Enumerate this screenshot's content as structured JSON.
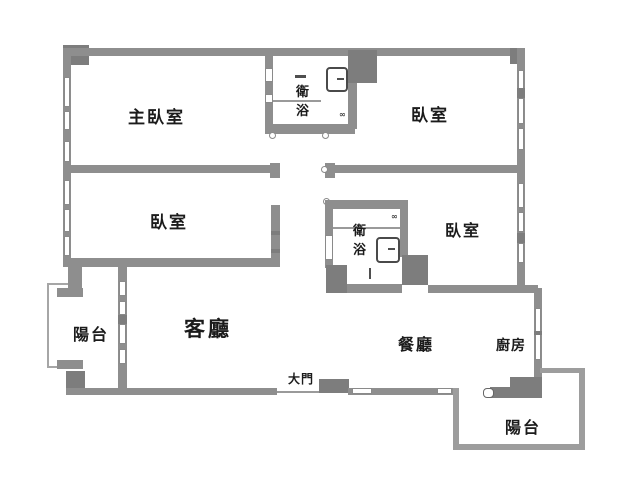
{
  "plan": {
    "rooms": {
      "master_bedroom": {
        "label": "主臥室"
      },
      "bedroom_top_right": {
        "label": "臥室"
      },
      "bedroom_mid_left": {
        "label": "臥室"
      },
      "bedroom_mid_right": {
        "label": "臥室"
      },
      "bathroom_top": {
        "label": "衛浴"
      },
      "bathroom_mid": {
        "label": "衛浴"
      },
      "living_room": {
        "label": "客廳"
      },
      "dining_room": {
        "label": "餐廳"
      },
      "kitchen": {
        "label": "廚房"
      },
      "balcony_left": {
        "label": "陽台"
      },
      "balcony_bottom_right": {
        "label": "陽台"
      }
    },
    "entrance": {
      "label": "大門"
    },
    "door_stop_mark": "∞",
    "colors": {
      "wall": "#8e8e8e",
      "wall_dark": "#7d7d7d",
      "railing": "#a6a6a6",
      "window_fill": "#ffffff",
      "text": "#1b1b1b",
      "background": "#ffffff"
    }
  }
}
